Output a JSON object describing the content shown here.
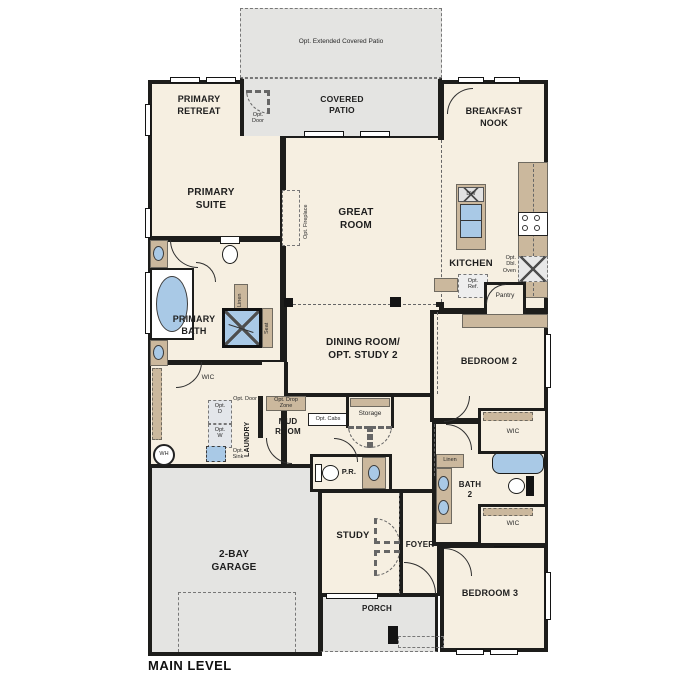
{
  "plan_title": "MAIN LEVEL",
  "colors": {
    "room_fill": "#f6efe1",
    "outdoor_fill": "#e4e4e2",
    "wall": "#1d1d1b",
    "cabinet_tan": "#cbb89d",
    "fixture_blue": "#a9c9e6",
    "text": "#1e1e1e"
  },
  "rooms": {
    "opt_extended_patio": "Opt. Extended Covered Patio",
    "covered_patio": "COVERED\nPATIO",
    "primary_retreat": "PRIMARY\nRETREAT",
    "primary_suite": "PRIMARY\nSUITE",
    "breakfast_nook": "BREAKFAST\nNOOK",
    "great_room": "GREAT\nROOM",
    "kitchen": "KITCHEN",
    "primary_bath": "PRIMARY\nBATH",
    "dining": "DINING ROOM/\nOPT. STUDY 2",
    "bedroom2": "BEDROOM 2",
    "mud_room": "MUD\nROOM",
    "laundry": "LAUNDRY",
    "storage": "Storage",
    "pantry": "Pantry",
    "powder_room": "P.R.",
    "bath2": "BATH\n2",
    "study": "STUDY",
    "foyer": "FOYER",
    "garage": "2-BAY\nGARAGE",
    "bedroom3": "BEDROOM 3",
    "porch": "PORCH"
  },
  "ann": {
    "opt_door_patio": "Opt.\nDoor",
    "opt_fireplace": "Opt. Fireplace",
    "dw": "DW",
    "opt_dbl_oven": "Opt.\nDbl.\nOven",
    "opt_ref": "Opt.\nRef.",
    "linen_primary": "Linen",
    "seat": "Seat",
    "wic_primary": "WIC",
    "wic_bed2": "WIC",
    "wic_bed3": "WIC",
    "linen_bath2": "Linen",
    "opt_d": "Opt.\nD",
    "opt_w": "Opt.\nW",
    "opt_door_laundry": "Opt. Door",
    "opt_sink": "Opt.\nSink",
    "wh": "WH",
    "opt_drop_zone": "Opt. Drop\nZone",
    "opt_cabs": "Opt. Cabs"
  }
}
